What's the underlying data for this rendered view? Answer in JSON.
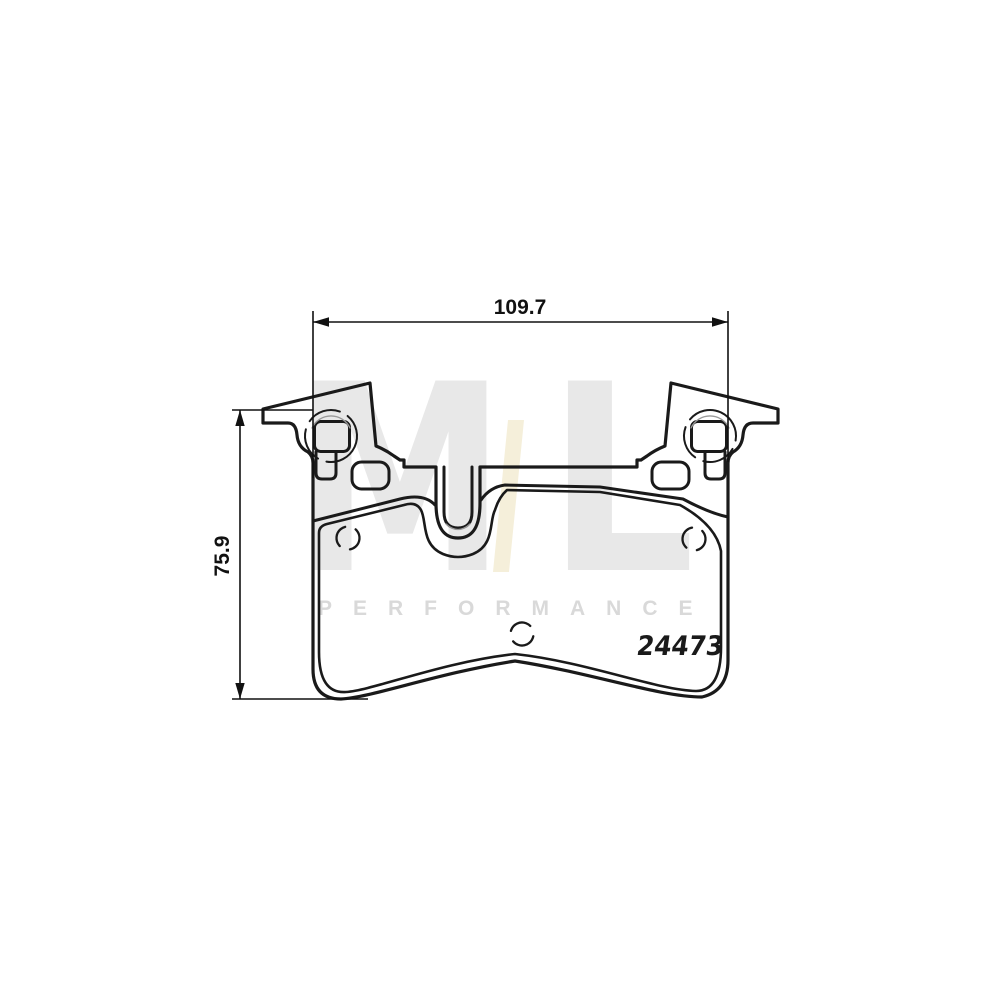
{
  "image": {
    "background": "#ffffff",
    "description": "Technical line drawing of a brake pad set, front view with spring clips"
  },
  "colors": {
    "line": "#1a1a1a",
    "thin_line": "#999999",
    "dimension": "#111111",
    "watermark_gray": "#e8e8e8",
    "watermark_cream": "#f5efda",
    "watermark_word_gray": "#d9d9d9"
  },
  "drawing": {
    "part_number": "24473",
    "width_dimension": "109.7",
    "height_dimension": "75.9"
  },
  "watermark": {
    "letter_m": "M",
    "letter_l": "L",
    "wordmark": "PERFORMANCE"
  }
}
